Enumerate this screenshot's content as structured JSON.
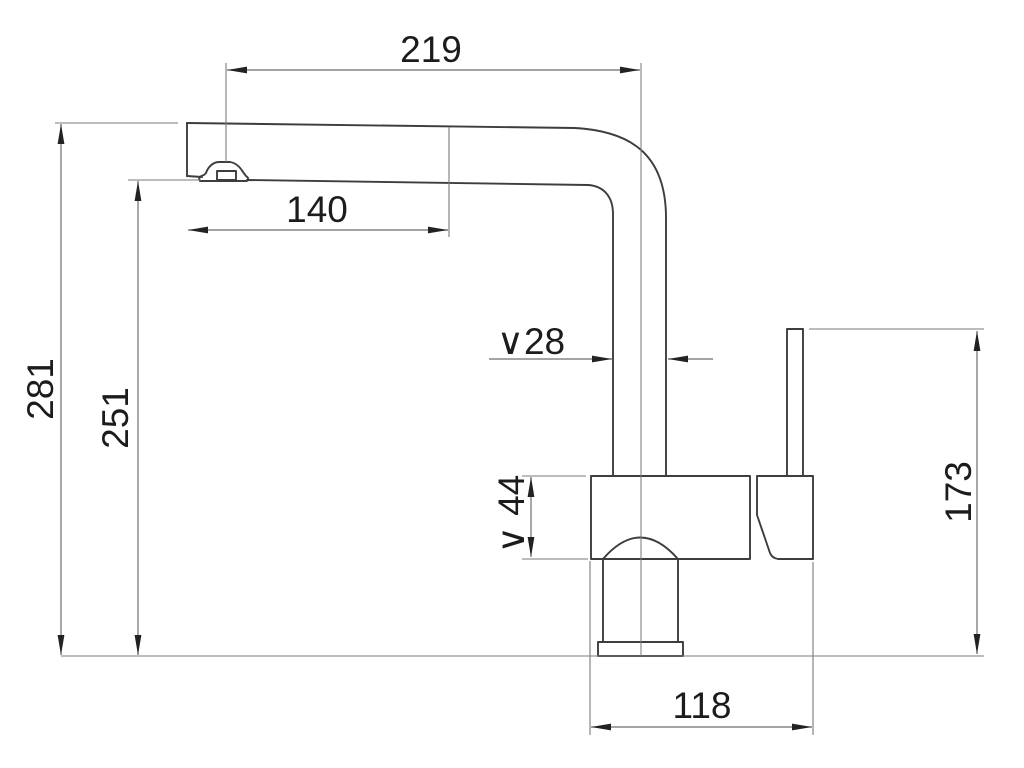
{
  "drawing": {
    "kind": "technical-dimension-drawing",
    "dimensions": {
      "spout_reach": "219",
      "spout_tip_offset": "140",
      "overall_height": "281",
      "aerator_height": "251",
      "spout_pipe_diameter": "∨28",
      "body_diameter": "∨ 44",
      "lever_height": "173",
      "base_depth": "118"
    }
  },
  "colors": {
    "background": "#ffffff",
    "outline": "#3d3d3d",
    "dimension": "#6e6e6e",
    "thin": "#7a7a7a",
    "arrow": "#222222",
    "text": "#1c1c1c"
  }
}
